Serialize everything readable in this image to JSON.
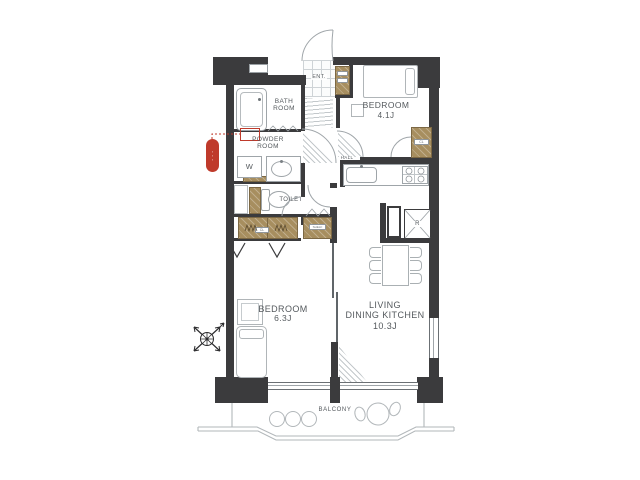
{
  "rooms": {
    "entrance": {
      "label": "ENT."
    },
    "bathroom": {
      "label_line1": "BATH",
      "label_line2": "ROOM"
    },
    "powder_room": {
      "label_line1": "POWDER",
      "label_line2": "ROOM"
    },
    "toilet": {
      "label": "TOILET"
    },
    "hall": {
      "label": "HALL"
    },
    "bedroom_1": {
      "label": "BEDROOM",
      "size": "4.1J"
    },
    "bedroom_2": {
      "label": "BEDROOM",
      "size": "6.3J"
    },
    "living_dining_kitchen": {
      "label_line1": "LIVING",
      "label_line2": "DINING KITCHEN",
      "size": "10.3J"
    },
    "balcony": {
      "label": "BALCONY"
    }
  },
  "labels": {
    "washer": "W",
    "refrigerator": "R",
    "closet": "CL",
    "shelf": "SHELF"
  },
  "annotation": {
    "badge_text": "・・・"
  },
  "colors": {
    "wall": "#3b3b3d",
    "wood": "#a78e5f",
    "red": "#bf3a2b",
    "line": "#9fa5a9",
    "text": "#54595d"
  }
}
